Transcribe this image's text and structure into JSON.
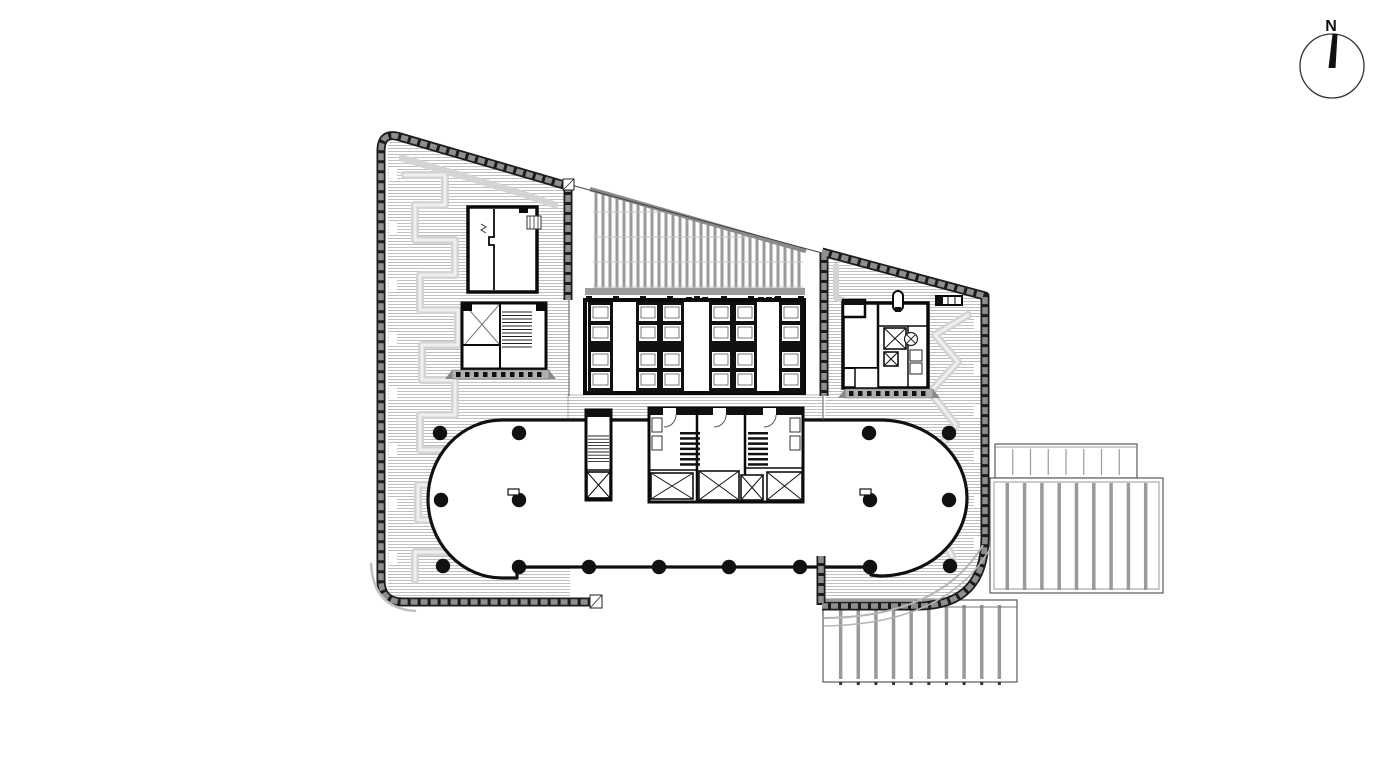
{
  "compass": {
    "label": "N"
  },
  "colors": {
    "ink": "#111111",
    "wall_base": "#1c1c1c",
    "wall_block": "#8e8e8e",
    "hatch_line": "#b0b0b0",
    "meander": "#d4d4d4",
    "meander_core": "#efefef",
    "glass_stripe": "#9a9a9a",
    "glass_edge": "#8a8a8a",
    "terrace_line": "#9a9a9a",
    "terrace_edge": "#4a4a4a",
    "platform": "#b0b0b0",
    "band_gray": "#9c9c9c",
    "curve_band": "#b5b5b5"
  },
  "columns": {
    "radius": 7.2,
    "points": [
      [
        440,
        433
      ],
      [
        519,
        433
      ],
      [
        869,
        433
      ],
      [
        949,
        433
      ],
      [
        441,
        500
      ],
      [
        519,
        500
      ],
      [
        870,
        500
      ],
      [
        949,
        500
      ],
      [
        443,
        566
      ],
      [
        519,
        567
      ],
      [
        589,
        567
      ],
      [
        659,
        567
      ],
      [
        729,
        567
      ],
      [
        800,
        567
      ],
      [
        870,
        567
      ],
      [
        950,
        566
      ]
    ]
  },
  "floor_markers": [
    [
      508,
      489
    ],
    [
      860,
      489
    ]
  ],
  "terraces": {
    "right_upper": {
      "x": 995,
      "y": 444,
      "w": 142,
      "h": 34,
      "lines": 7,
      "weight": 1.2
    },
    "right_main": {
      "x": 990,
      "y": 478,
      "w": 173,
      "h": 115,
      "lines": 9,
      "weight": 3.5
    },
    "bottom": {
      "x": 823,
      "y": 600,
      "w": 194,
      "h": 82,
      "lines": 10,
      "weight": 3.5
    }
  },
  "glass_roof": {
    "x1": 593,
    "y1": 191,
    "x2": 803,
    "y2": 251,
    "bottom": 292,
    "spacing": 7,
    "cross_y": [
      212,
      237,
      262,
      287
    ]
  },
  "core_posts": {
    "y": 296,
    "w": 6,
    "h": 7,
    "xs": [
      586,
      613,
      640,
      667,
      694,
      721,
      748,
      775,
      798
    ]
  },
  "door_blocks": {
    "y": 297,
    "size": 6,
    "xs": [
      686,
      694,
      702,
      758,
      766,
      774
    ]
  },
  "elevator_banks": {
    "y": 302,
    "h": 91,
    "cell_ys": [
      305,
      325,
      352,
      372
    ],
    "cell_h": 16,
    "banks": [
      {
        "x": 588,
        "w": 25
      },
      {
        "x": 636,
        "w": 24
      },
      {
        "x": 660,
        "w": 24
      },
      {
        "x": 709,
        "w": 24
      },
      {
        "x": 733,
        "w": 24
      },
      {
        "x": 779,
        "w": 24
      }
    ]
  },
  "wall_notches": {
    "left": {
      "x": 389,
      "w": 8,
      "h": 12,
      "ys": [
        168,
        223,
        278,
        333,
        388,
        443,
        498,
        553
      ]
    },
    "right": {
      "x": 974,
      "w": 8,
      "h": 12,
      "ys": [
        318,
        362,
        406,
        450,
        494,
        538
      ]
    }
  }
}
